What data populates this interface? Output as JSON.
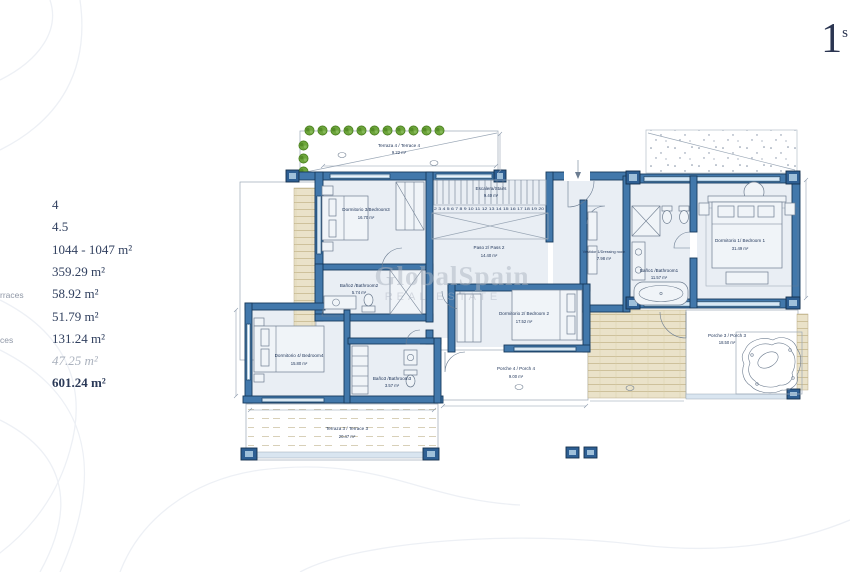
{
  "floor_badge": {
    "number": "1",
    "superscript": "s"
  },
  "specs": {
    "rows": [
      {
        "label": "",
        "value": "4"
      },
      {
        "label": "",
        "value": "4.5"
      },
      {
        "label": "",
        "value": "1044 - 1047 m²"
      },
      {
        "label": "",
        "value": "359.29 m²"
      },
      {
        "label": "rraces",
        "value": "58.92 m²"
      },
      {
        "label": "",
        "value": "51.79 m²"
      },
      {
        "label": "ces",
        "value": "131.24 m²"
      },
      {
        "label": "",
        "value": "47.25 m²"
      },
      {
        "label": "",
        "value": "601.24 m²"
      }
    ]
  },
  "watermark": {
    "line1": "GlobalSpain",
    "line2": "REAL ESTATE"
  },
  "plan": {
    "rooms": [
      {
        "name": "Terraza 4 / Terrace 4",
        "area": "9.22 m²"
      },
      {
        "name": "Dormitorio 3/Bedroom3",
        "area": "16.70 m²"
      },
      {
        "name": "Escalera/Stairs",
        "area": "9.40 m²"
      },
      {
        "name": "Paso 2/ Pass 2",
        "area": "14.40 m²"
      },
      {
        "name": "Baño2 /Bathroom2",
        "area": "5.74 m²"
      },
      {
        "name": "Baño3 /Bathroom3",
        "area": "3.57 m²"
      },
      {
        "name": "Dormitorio 4/ Bedroom4",
        "area": "15.80 m²"
      },
      {
        "name": "Dormitorio 2/ Bedroom 2",
        "area": "17.52 m²"
      },
      {
        "name": "Vestidor 1/Dressing room",
        "area": "7.98 m²"
      },
      {
        "name": "Baño1 /Bathroom1",
        "area": "11.57 m²"
      },
      {
        "name": "Dormitorio 1/ Bedroom 1",
        "area": "31.49 m²"
      },
      {
        "name": "Porche 4 / Porch 4",
        "area": "9.00 m²"
      },
      {
        "name": "Porche 3 / Porch 3",
        "area": "18.50 m²"
      },
      {
        "name": "Terraza 3 / Terrace 3",
        "area": "20.47 m²"
      }
    ],
    "stairs_numbers": "2 3 4 5 6 7 8 9 10 11 12 13 14 15 16 17 18 19 20"
  }
}
